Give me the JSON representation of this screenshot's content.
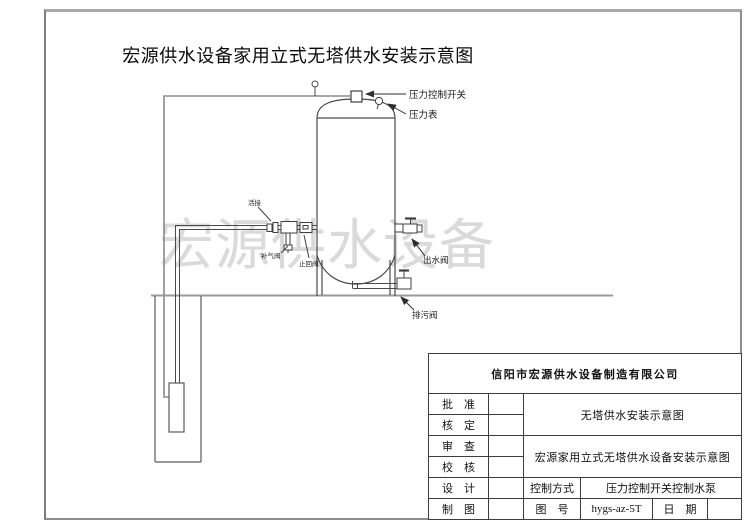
{
  "title": "宏源供水设备家用立式无塔供水安装示意图",
  "watermark": "宏源供水设备",
  "diagram": {
    "labels": {
      "pressure_switch": "压力控制开关",
      "pressure_gauge": "压力表",
      "union": "活接",
      "air_valve": "补气阀",
      "check_valve": "止回阀",
      "outlet_valve": "出水阀",
      "drain_valve": "排污阀"
    }
  },
  "title_block": {
    "company": "信阳市宏源供水设备制造有限公司",
    "rows": [
      {
        "label": "批　准"
      },
      {
        "label": "核　定"
      },
      {
        "label": "审　查"
      },
      {
        "label": "校　核"
      },
      {
        "label": "设　计"
      },
      {
        "label": "制　图"
      }
    ],
    "drawing_name_1": "无塔供水安装示意图",
    "drawing_name_2": "宏源家用立式无塔供水设备安装示意图",
    "control_mode_label": "控制方式",
    "control_mode_value": "压力控制开关控制水泵",
    "figure_no_label": "图　号",
    "figure_no_value": "hygs-az-5T",
    "date_label": "日　期"
  }
}
